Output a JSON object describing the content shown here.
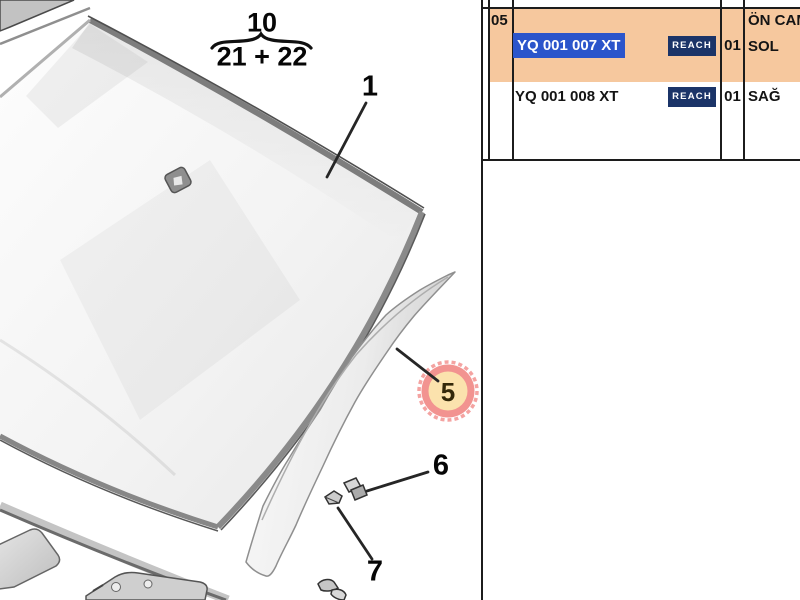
{
  "diagram": {
    "assembly_ref": {
      "numerator": "10",
      "denominator": "21 + 22"
    },
    "callouts": {
      "windshield": "1",
      "pillar_trim": "5",
      "clip_upper": "6",
      "clip_lower": "7"
    }
  },
  "table": {
    "item_no": "05",
    "group_desc": "ÖN CAM",
    "rows": [
      {
        "part_number": "YQ 001 007 XT",
        "badge": "REACH",
        "qty": "01",
        "desc": "SOL"
      },
      {
        "part_number": "YQ 001 008 XT",
        "badge": "REACH",
        "qty": "01",
        "desc": "SAĞ"
      }
    ]
  },
  "colors": {
    "row_highlight": "#f6c89e",
    "selection_bg": "#2b55cb",
    "selection_text": "#ffffff",
    "badge_bg": "#1b3468",
    "badge_text": "#ffffff",
    "hotspot_ring": "#f29390",
    "hotspot_fill": "#fbe2ad"
  }
}
